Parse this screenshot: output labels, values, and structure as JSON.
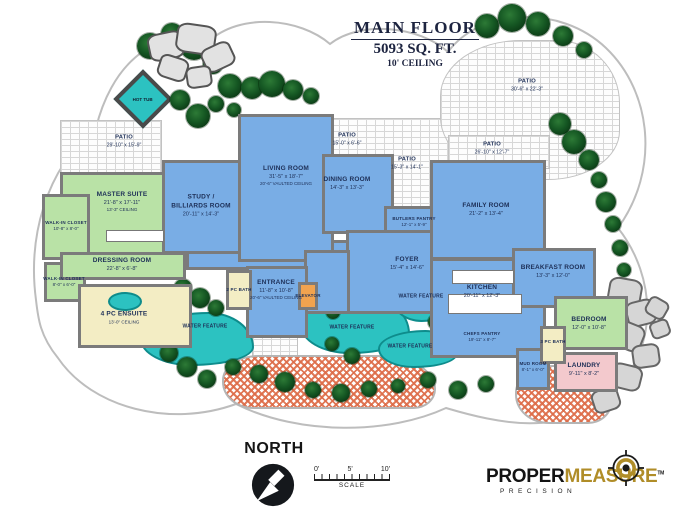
{
  "title": {
    "name": "MAIN FLOOR",
    "area": "5093 SQ. FT.",
    "ceiling": "10' CEILING"
  },
  "rooms": [
    {
      "name": "MASTER SUITE",
      "dims": "21'-8\" x 17'-11\"",
      "note": "13'-3\" CEILING"
    },
    {
      "name": "WALK-IN CLOSET",
      "dims": "10'-8\" x 8'-0\""
    },
    {
      "name": "WALK-IN CLOSET",
      "dims": "8'-0\" x 6'-0\""
    },
    {
      "name": "DRESSING ROOM",
      "dims": "22'-8\" x 6'-8\""
    },
    {
      "name": "4 PC ENSUITE",
      "note": "13'-0\" CEILING"
    },
    {
      "name": "STUDY / BILLIARDS ROOM",
      "dims": "20'-11\" x 14'-3\""
    },
    {
      "name": "LIVING ROOM",
      "dims": "31'-5\" x 18'-7\"",
      "note": "20'-6\" VAULTED CEILING"
    },
    {
      "name": "DINING ROOM",
      "dims": "14'-3\" x 13'-3\""
    },
    {
      "name": "BUTLERS PANTRY",
      "dims": "12'-1\" x 5'-9\""
    },
    {
      "name": "FOYER",
      "dims": "15'-4\" x 14'-6\""
    },
    {
      "name": "ENTRANCE",
      "dims": "11'-8\" x 10'-8\"",
      "note": "20'-6\" VAULTED CEILING"
    },
    {
      "name": "2 PC BATH"
    },
    {
      "name": "ELEVATOR"
    },
    {
      "name": "FAMILY ROOM",
      "dims": "21'-2\" x 13'-4\""
    },
    {
      "name": "KITCHEN",
      "dims": "20'-11\" x 12'-3\""
    },
    {
      "name": "CHEFS PANTRY",
      "dims": "19'-11\" x 8'-7\""
    },
    {
      "name": "BREAKFAST ROOM",
      "dims": "13'-3\" x 12'-0\""
    },
    {
      "name": "BEDROOM",
      "dims": "12'-0\" x 10'-8\""
    },
    {
      "name": "LAUNDRY",
      "dims": "9'-11\" x 8'-2\""
    },
    {
      "name": "MUD ROOM",
      "dims": "8'-1\" x 6'-0\""
    },
    {
      "name": "3 PC BATH"
    }
  ],
  "patios": [
    {
      "name": "PATIO",
      "dims": "29'-10\" x 15'-9\""
    },
    {
      "name": "PATIO",
      "dims": "15'-0\" x 6'-6\""
    },
    {
      "name": "PATIO",
      "dims": "15'-3\" x 14'-1\""
    },
    {
      "name": "PATIO",
      "dims": "26'-10\" x 12'-7\""
    },
    {
      "name": "PATIO",
      "dims": "30'-6\" x 22'-3\""
    }
  ],
  "site": {
    "hot_tub": "HOT TUB",
    "water_feature": "WATER FEATURE"
  },
  "compass": {
    "label": "NORTH"
  },
  "scale": {
    "ticks": [
      "0'",
      "5'",
      "10'"
    ],
    "label": "SCALE"
  },
  "logo": {
    "word1": "PROPER",
    "word2": "MEASURE",
    "tm": "TM",
    "tagline": "PRECISION"
  },
  "colors": {
    "room_blue": "#79ade5",
    "room_green": "#b9e2a6",
    "room_yellow": "#f3edc4",
    "room_pink": "#f3c9cd",
    "elevator_orange": "#f1a34f",
    "water_teal": "#2cc2c1",
    "wall_gray": "#7b7b7b",
    "label_navy": "#1d2f57",
    "driveway_orange": "#dd6b47",
    "logo_gold": "#b08d28"
  }
}
